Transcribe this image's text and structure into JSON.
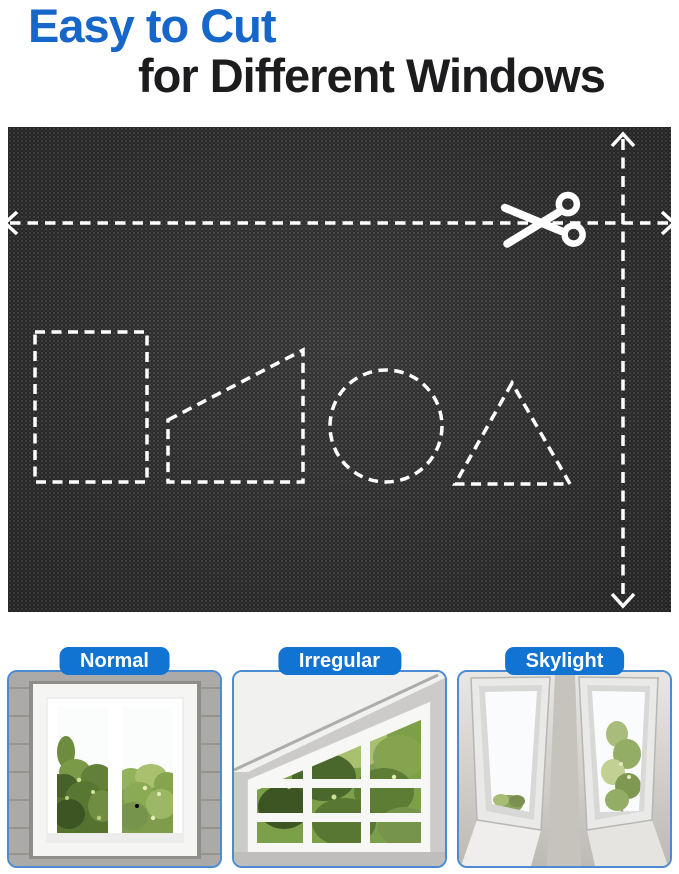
{
  "header": {
    "title_accent": "Easy to Cut",
    "title_rest": "for Different Windows",
    "accent_color": "#1667c9",
    "text_color": "#1c1c1e"
  },
  "fabric_panel": {
    "description": "black blackout-fabric swatch with white dashed cutting guides",
    "fabric_color": "#252525",
    "guide_color": "#ffffff",
    "icons": {
      "scissors_icon": "scissors cutting along dashed line",
      "width_arrow": "double-headed horizontal dashed arrow (full width)",
      "height_arrow": "double-headed vertical dashed arrow (full height)"
    },
    "cut_shapes": [
      "rectangle",
      "right-trapezoid",
      "circle",
      "triangle"
    ]
  },
  "window_types": [
    {
      "label": "Normal"
    },
    {
      "label": "Irregular"
    },
    {
      "label": "Skylight"
    }
  ],
  "colors": {
    "label_pill": "#1173d2",
    "card_border": "#4c8bd2",
    "foliage_green": "#6f8e41",
    "wall_gray": "#abaaa8",
    "ceiling_white": "#f1f1f0"
  }
}
